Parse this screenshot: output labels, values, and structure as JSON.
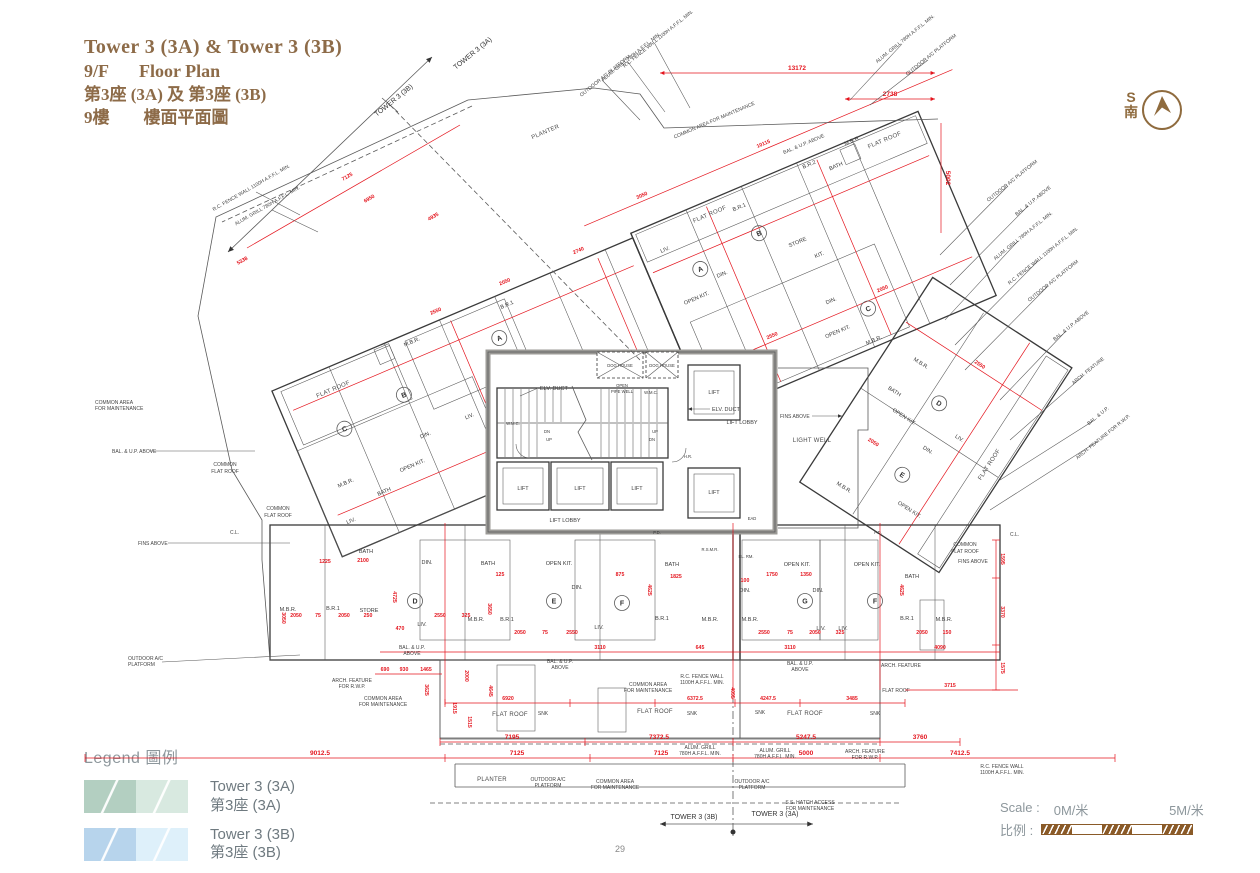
{
  "title": {
    "l1": "Tower 3 (3A) & Tower 3 (3B)",
    "l2a": "9/F",
    "l2b": "Floor Plan",
    "l3": "第3座 (3A) 及 第3座 (3B)",
    "l4a": "9樓",
    "l4b": "樓面平面圖"
  },
  "compass": {
    "s": "S",
    "south": "南"
  },
  "legend": {
    "heading": "Legend 圖例",
    "items": [
      {
        "en": "Tower 3 (3A)",
        "zh": "第3座 (3A)"
      },
      {
        "en": "Tower 3 (3B)",
        "zh": "第3座 (3B)"
      }
    ]
  },
  "colors": {
    "tower_a_dark": "#b3cfc1",
    "tower_a_light": "#d8e9e0",
    "tower_b_dark": "#b7d4ec",
    "tower_b_light": "#def0fa",
    "dim_red": "#e4151e",
    "title_brown": "#8d6b48",
    "scale_brown": "#8a5a28"
  },
  "scale": {
    "en": "Scale :",
    "zh": "比例 :",
    "zero": "0M/米",
    "five": "5M/米"
  },
  "splits": {
    "a": "TOWER 3 (3A)",
    "b": "TOWER 3 (3B)"
  },
  "units": {
    "a": "A",
    "b": "B",
    "c": "C",
    "d": "D",
    "e": "E",
    "f": "F",
    "g": "G"
  },
  "rooms": {
    "mbr": "M.B.R.",
    "br1": "B.R.1",
    "br2": "B.R.2",
    "bath": "BATH",
    "din": "DIN.",
    "liv": "LIV.",
    "okit": "OPEN KIT.",
    "kit": "KIT.",
    "store": "STORE",
    "flat": "FLAT ROOF",
    "cfr1": "COMMON",
    "cfr2": "FLAT ROOF",
    "planter": "PLANTER"
  },
  "core": {
    "lift": "LIFT",
    "lobby": "LIFT LOBBY",
    "elv": "ELV. DUCT",
    "open": "OPEN",
    "pipe": "PIPE WELL",
    "wmc": "W.M.C.",
    "dog": "DOG HOUSE",
    "up": "UP",
    "dn": "DN",
    "lw": "LIGHT WELL",
    "elrm": "EL. RM.",
    "rsmr": "R.S.M.R.",
    "hr": "H.R.",
    "pd": "P.D.",
    "ead": "EAD",
    "cl": "C.L."
  },
  "annos": {
    "oac1": "OUTDOOR A/C",
    "oac2": "PLATFORM",
    "oacF": "OUTDOOR A/C PLATFORM",
    "alum1": "ALUM. GRILL",
    "alum2": "780H A.F.F.L. MIN.",
    "alumF": "ALUM. GRILL 780H A.F.F.L. MIN.",
    "rcf1": "R.C. FENCE WALL",
    "rcf2": "1100H A.F.F.L. MIN.",
    "rcfF": "R.C. FENCE WALL 1100H A.F.F.L. MIN.",
    "com1": "COMMON AREA",
    "com2": "FOR MAINTENANCE",
    "comF": "COMMON AREA FOR MAINTENANCE",
    "arch1": "ARCH. FEATURE",
    "arch2": "FOR R.W.P.",
    "archF": "ARCH. FEATURE FOR R.W.P.",
    "arch": "ARCH. FEATURE",
    "ss1": "S.S. HATCH ACCESS",
    "ss2": "FOR MAINTENANCE",
    "balup": "BAL. & U.P.",
    "above": "ABOVE",
    "balupaF": "BAL. & U.P. ABOVE",
    "fins": "FINS ABOVE",
    "snk": "SNK"
  },
  "dims": {
    "d13172": "13172",
    "d2738": "2738",
    "d5002": "5002",
    "d10115": "10115",
    "d7195": "7195",
    "d7372": "7372.5",
    "d5247": "5247.5",
    "d3760": "3760",
    "d9012": "9012.5",
    "d7125": "7125",
    "d5000": "5000",
    "d7412": "7412.5",
    "d6920": "6920",
    "d6372": "6372.5",
    "d4247": "4247.5",
    "d3485": "3485",
    "d3715": "3715",
    "d1915": "1915",
    "d1515": "1515",
    "d3625": "3625",
    "d2000": "2000",
    "d4645": "4645",
    "d4095": "4095",
    "d6950": "6950",
    "d4935": "4935",
    "d5338": "5338",
    "d690": "690",
    "d930": "930",
    "d1465": "1465",
    "d1595": "1595",
    "d3370": "3370",
    "d1575": "1575",
    "d2050": "2050",
    "d2550": "2550",
    "d75": "75",
    "d125": "125",
    "d250": "250",
    "d325": "325",
    "d4725": "4725",
    "d4625": "4625",
    "d2100": "2100",
    "d1225": "1225",
    "d875": "875",
    "d1750": "1750",
    "d1350": "1350",
    "d100": "100",
    "d150": "150",
    "d3110": "3110",
    "d3650": "3650",
    "d4090": "4090",
    "d645": "645",
    "d1825": "1825",
    "d3050": "3050",
    "d2740": "2740",
    "d470": "470"
  },
  "page": {
    "num": "29"
  }
}
